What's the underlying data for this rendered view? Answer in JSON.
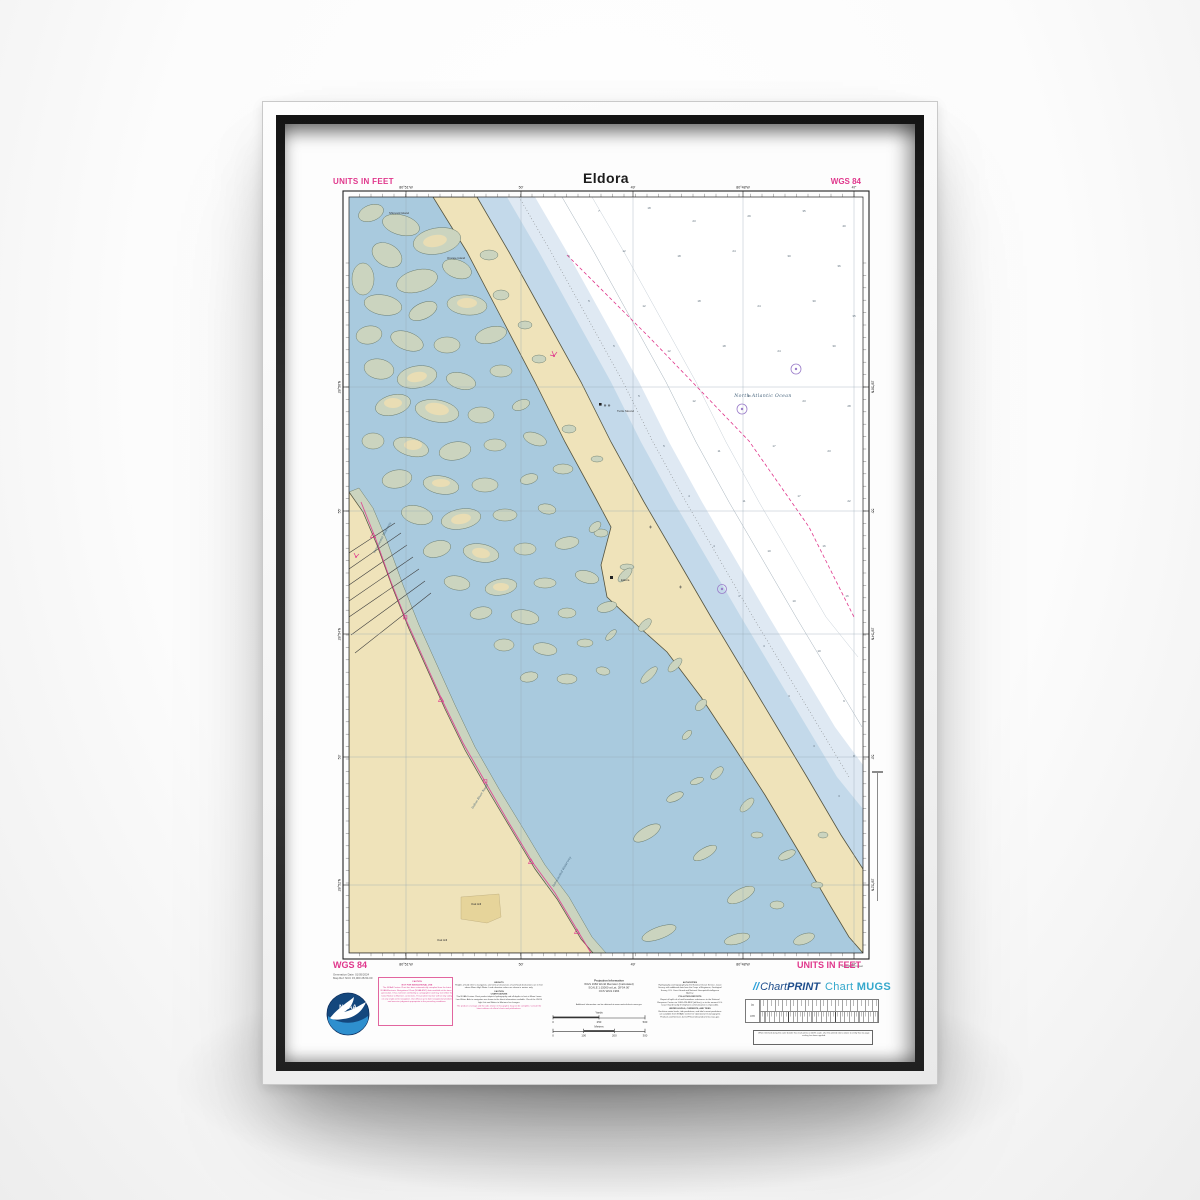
{
  "header": {
    "units": "UNITS IN FEET",
    "title": "Eldora",
    "datum": "WGS 84"
  },
  "footer": {
    "datum": "WGS 84",
    "units": "UNITS IN FEET",
    "meta_line1": "Generation Date: 01/05/2024",
    "meta_line2": "Map Ref: NCC 15,000  28-54.00",
    "caution": {
      "title": "CAUTION",
      "subtitle": "NOT FOR NAVIGATIONAL USE",
      "body": "The NOAA Custom Chart has been automatically compiled from the latest NOAA Electronic Navigational Chart (NOAA ENC) data available at the time of generation. It has not been verified by a cartographer and may not reflect the latest Notice to Mariners corrections. The prudent mariner will not rely solely on any single aid to navigation. Use official, up to date navigational products and exercise judgment appropriate to the prevailing conditions."
    },
    "heights": {
      "h1": "HEIGHTS",
      "b1": "Heights of land refer to navigation, and vertical clearances of overhead obstructions are in feet above Mean High Water. Land elevation values are shown in meters only.",
      "h2": "CAUTION",
      "h2b": "CHART DATUMS",
      "b2": "The NOAA Custom Chart product depicts hydrography and all depths in feet at Mean Lower Low Water. Aids to navigation are shown to the latest information available. Check the USCG Light List and Notice to Mariners for changes.",
      "m1": "The product coverage and the aids shown in this graphic may not be complete. Consult the latest editions of official charts and publications."
    },
    "projection": {
      "title": "Projection Information",
      "l1": "WGS 1984 World Mercator (Calculated)",
      "l2": "SCALE 1:15000 at Lat. 28°54.00'",
      "l3": "OCS WGS 1984",
      "info": "Additional information can be obtained at www.nauticalcharts.noaa.gov"
    },
    "scalebar": {
      "top_label": "Yards",
      "top_ticks": [
        "0",
        "250",
        "500"
      ],
      "bottom_label": "Meters",
      "bottom_ticks": [
        "0",
        "100",
        "200",
        "300"
      ]
    },
    "authorities": {
      "h1": "AUTHORITIES",
      "b1": "Hydrography and topography by the National Ocean Service, Coast Survey, with additional data from the Corps of Engineers, Geological Survey, U.S. Coast Guard and National Geospatial-Intelligence Agency.",
      "h2": "POLLUTION REPORTS",
      "b2": "Report all spills of oil and hazardous substances to the National Response Center via 1-800-424-8802 (toll free), or to the nearest U.S. Coast Guard facility if telephone communication is impossible.",
      "h3": "WATER LEVELS, CURRENTS, AND TIDES",
      "b3": "Real-time water levels, tide predictions, and tidal current predictions are available from NOAA's Center for Operational Oceanographic Products and Services (CO-OPS) at tidesandcurrents.noaa.gov."
    },
    "brands": {
      "print_icon": "//",
      "print_a": "Chart",
      "print_b": "PRINT",
      "mugs_a": "Chart",
      "mugs_b": "MUGS"
    },
    "ruler": {
      "left_top": "in",
      "left_bottom": "cm",
      "note": "When trimmed along the outer border this chart prints at 100% scale. Use the printed rulers above to verify that no page scaling has been applied."
    },
    "noaa_label": "NOAA",
    "margin_note": "Soundings in feet"
  },
  "map": {
    "sea_label": "North Atlantic Ocean",
    "labels": [
      {
        "text": "Shipyard Island",
        "x": 40,
        "y": 17,
        "rot": 0,
        "cls": "pl"
      },
      {
        "text": "Orange Island",
        "x": 98,
        "y": 62,
        "rot": 0,
        "cls": "pl"
      },
      {
        "text": "Turtle Mound",
        "x": 268,
        "y": 215,
        "rot": 0,
        "cls": "pl"
      },
      {
        "text": "Eldora",
        "x": 272,
        "y": 384,
        "rot": 0,
        "cls": "pl"
      },
      {
        "text": "Intracoastal Waterway",
        "x": 26,
        "y": 356,
        "rot": -62,
        "cls": "wl"
      },
      {
        "text": "Indian River North",
        "x": 124,
        "y": 612,
        "rot": -58,
        "cls": "wl"
      },
      {
        "text": "Intracoastal Waterway",
        "x": 205,
        "y": 690,
        "rot": -60,
        "cls": "wl"
      },
      {
        "text": "Oak Hill",
        "x": 122,
        "y": 708,
        "rot": 0,
        "cls": "pl"
      },
      {
        "text": "Oak Hill",
        "x": 88,
        "y": 744,
        "rot": 0,
        "cls": "pl"
      }
    ],
    "soundings": [
      [
        250,
        15,
        "7"
      ],
      [
        300,
        12,
        "18"
      ],
      [
        345,
        25,
        "23"
      ],
      [
        400,
        20,
        "29"
      ],
      [
        455,
        15,
        "35"
      ],
      [
        495,
        30,
        "40"
      ],
      [
        220,
        60,
        "6"
      ],
      [
        275,
        55,
        "12"
      ],
      [
        330,
        60,
        "18"
      ],
      [
        385,
        55,
        "24"
      ],
      [
        440,
        60,
        "30"
      ],
      [
        490,
        70,
        "36"
      ],
      [
        240,
        105,
        "5"
      ],
      [
        295,
        110,
        "12"
      ],
      [
        350,
        105,
        "18"
      ],
      [
        410,
        110,
        "24"
      ],
      [
        465,
        105,
        "30"
      ],
      [
        505,
        120,
        "35"
      ],
      [
        265,
        150,
        "5"
      ],
      [
        320,
        155,
        "12"
      ],
      [
        375,
        150,
        "18"
      ],
      [
        430,
        155,
        "24"
      ],
      [
        485,
        150,
        "30"
      ],
      [
        290,
        200,
        "5"
      ],
      [
        345,
        205,
        "12"
      ],
      [
        400,
        200,
        "18"
      ],
      [
        455,
        205,
        "23"
      ],
      [
        500,
        210,
        "28"
      ],
      [
        315,
        250,
        "5"
      ],
      [
        370,
        255,
        "11"
      ],
      [
        425,
        250,
        "17"
      ],
      [
        480,
        255,
        "23"
      ],
      [
        340,
        300,
        "4"
      ],
      [
        395,
        305,
        "11"
      ],
      [
        450,
        300,
        "17"
      ],
      [
        500,
        305,
        "22"
      ],
      [
        365,
        350,
        "4"
      ],
      [
        420,
        355,
        "10"
      ],
      [
        475,
        350,
        "16"
      ],
      [
        390,
        400,
        "4"
      ],
      [
        445,
        405,
        "10"
      ],
      [
        498,
        400,
        "16"
      ],
      [
        415,
        450,
        "3"
      ],
      [
        470,
        455,
        "10"
      ],
      [
        440,
        500,
        "3"
      ],
      [
        495,
        505,
        "9"
      ],
      [
        465,
        550,
        "3"
      ],
      [
        505,
        560,
        "8"
      ],
      [
        490,
        600,
        "3"
      ]
    ],
    "lons": [
      {
        "x": 57,
        "t": "80°51'W"
      },
      {
        "x": 172,
        "t": "50'"
      },
      {
        "x": 284,
        "t": "49'"
      },
      {
        "x": 394,
        "t": "80°48'W"
      },
      {
        "x": 505,
        "t": "47'"
      }
    ],
    "lats": [
      {
        "y": 190,
        "t": "28°56'N"
      },
      {
        "y": 314,
        "t": "55'"
      },
      {
        "y": 437,
        "t": "28°54'N"
      },
      {
        "y": 560,
        "t": "53'"
      },
      {
        "y": 688,
        "t": "28°52'N"
      }
    ]
  },
  "colors": {
    "magenta": "#e0378c",
    "water": "#a9cade",
    "shoal_inner": "#c3d9ea",
    "shoal_outer": "#dfe9f3",
    "land": "#efe3ba",
    "marsh": "#cbd4bf",
    "grid": "#93a5b2",
    "brand_print": "#1f4e8c",
    "brand_mugs": "#35a8cc",
    "noaa_blue": "#14477d",
    "noaa_light": "#2e8fce"
  }
}
